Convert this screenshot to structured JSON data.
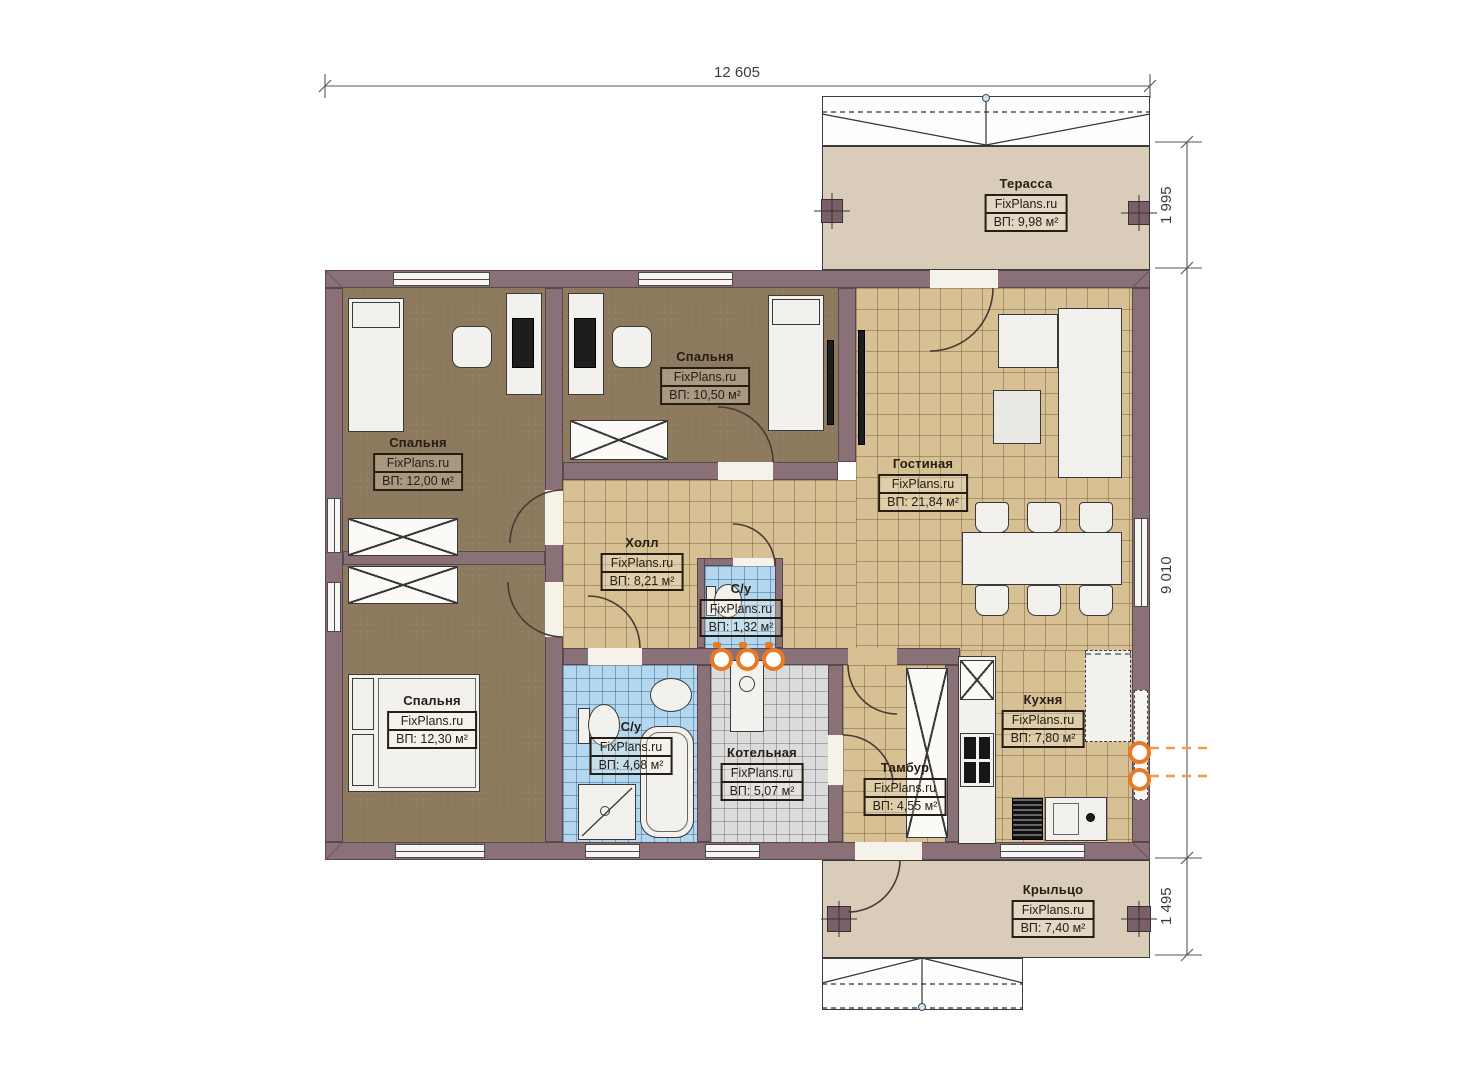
{
  "dimensions": {
    "top_width": "12 605",
    "terrace_depth": "1 995",
    "main_height": "9 010",
    "porch_depth": "1 495"
  },
  "rooms": {
    "terrace": {
      "title": "Терасса",
      "brand": "FixPlans.ru",
      "area": "ВП: 9,98 м²"
    },
    "bedroom_top_left": {
      "title": "Спальня",
      "brand": "FixPlans.ru",
      "area": "ВП: 12,00 м²"
    },
    "bedroom_top_middle": {
      "title": "Спальня",
      "brand": "FixPlans.ru",
      "area": "ВП: 10,50 м²"
    },
    "living_room": {
      "title": "Гостиная",
      "brand": "FixPlans.ru",
      "area": "ВП: 21,84 м²"
    },
    "hall": {
      "title": "Холл",
      "brand": "FixPlans.ru",
      "area": "ВП: 8,21 м²"
    },
    "wc_small": {
      "title": "С/у",
      "brand": "FixPlans.ru",
      "area": "ВП: 1,32 м²"
    },
    "bedroom_bottom_left": {
      "title": "Спальня",
      "brand": "FixPlans.ru",
      "area": "ВП: 12,30 м²"
    },
    "bathroom": {
      "title": "С/у",
      "brand": "FixPlans.ru",
      "area": "ВП: 4,68 м²"
    },
    "boiler_room": {
      "title": "Котельная",
      "brand": "FixPlans.ru",
      "area": "ВП: 5,07 м²"
    },
    "vestibule": {
      "title": "Тамбур",
      "brand": "FixPlans.ru",
      "area": "ВП: 4,55 м²"
    },
    "kitchen": {
      "title": "Кухня",
      "brand": "FixPlans.ru",
      "area": "ВП: 7,80 м²"
    },
    "porch": {
      "title": "Крыльцо",
      "brand": "FixPlans.ru",
      "area": "ВП: 7,40 м²"
    }
  },
  "colors": {
    "wall": "#8a7177",
    "carpet": "#8d795e",
    "tile_beige": "#d6c094",
    "tile_blue": "#b3d7ee",
    "tile_gray": "#dbdbdb",
    "deck": "#d9ccb8",
    "utility_accent": "#e87a25",
    "label_ink": "#261d15"
  }
}
